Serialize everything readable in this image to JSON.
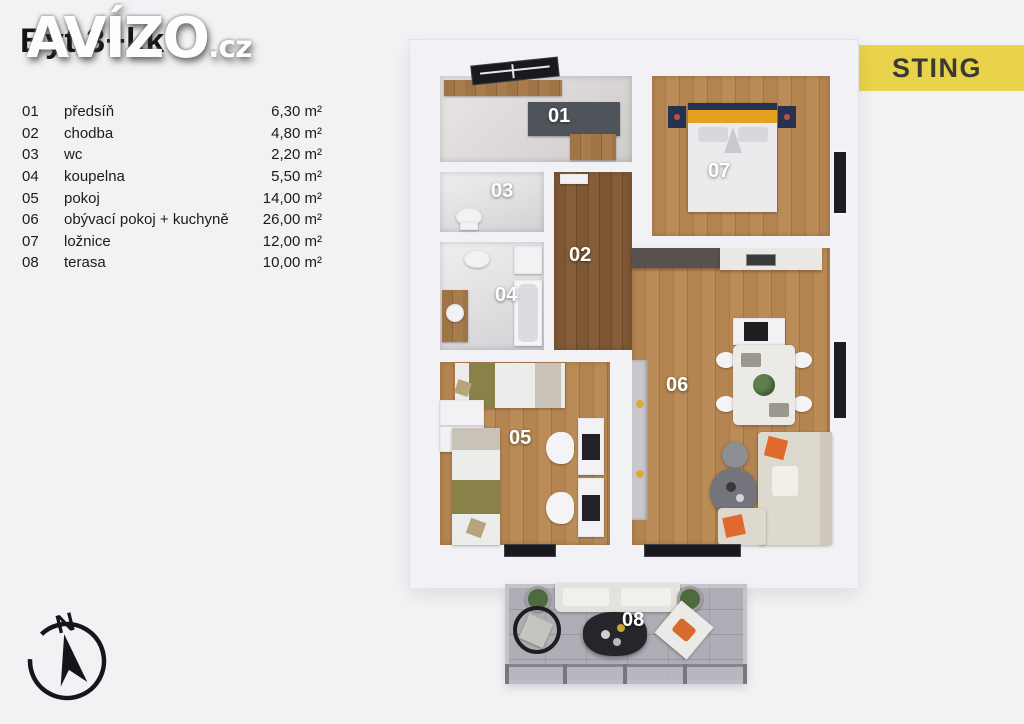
{
  "page": {
    "title": "Byt 3+kk",
    "watermark_main": "AVÍZO",
    "watermark_suffix": ".cz",
    "brand": "STING"
  },
  "colors": {
    "brand_bg": "#e8d34a",
    "wood_floor": "#b0814e",
    "wood_floor_dark": "#7b5634",
    "terrace_floor": "#a6a6ae",
    "accent_orange": "#e06a2d",
    "bed_blanket_orange": "#e5a11f",
    "nightstand_navy": "#26324f"
  },
  "legend": {
    "rows": [
      {
        "num": "01",
        "name": "předsíň",
        "area": "6,30 m²"
      },
      {
        "num": "02",
        "name": "chodba",
        "area": "4,80 m²"
      },
      {
        "num": "03",
        "name": "wc",
        "area": "2,20 m²"
      },
      {
        "num": "04",
        "name": "koupelna",
        "area": "5,50 m²"
      },
      {
        "num": "05",
        "name": "pokoj",
        "area": "14,00 m²"
      },
      {
        "num": "06",
        "name": "obývací pokoj + kuchyně",
        "area": "26,00 m²"
      },
      {
        "num": "07",
        "name": "ložnice",
        "area": "12,00 m²"
      },
      {
        "num": "08",
        "name": "terasa",
        "area": "10,00 m²"
      }
    ]
  },
  "floorplan": {
    "labels": {
      "r01": "01",
      "r02": "02",
      "r03": "03",
      "r04": "04",
      "r05": "05",
      "r06": "06",
      "r07": "07",
      "r08": "08"
    }
  },
  "compass": {
    "north": "N"
  }
}
